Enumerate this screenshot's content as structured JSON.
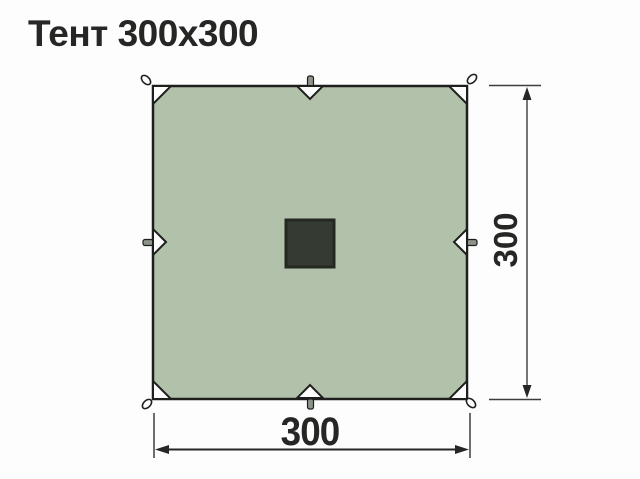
{
  "title": "Тент 300x300",
  "dimensions": {
    "width": "300",
    "height": "300"
  },
  "diagram": {
    "description": "top view of square tarp",
    "attachment_points": [
      "corner-loop-top-left",
      "corner-loop-top-right",
      "corner-loop-bottom-left",
      "corner-loop-bottom-right",
      "edge-loop-top",
      "edge-loop-right",
      "edge-loop-bottom",
      "edge-loop-left"
    ],
    "center_feature": "logo-patch"
  },
  "colors": {
    "background": "#fdfdfd",
    "ink": "#262624",
    "outline": "#1e1e1c",
    "tarp-fill": "#b2c1aa",
    "tab-fill": "#8d938a",
    "patch-fill": "#353b33",
    "patch-border": "#232920",
    "dim-line": "#3d3d3b"
  }
}
